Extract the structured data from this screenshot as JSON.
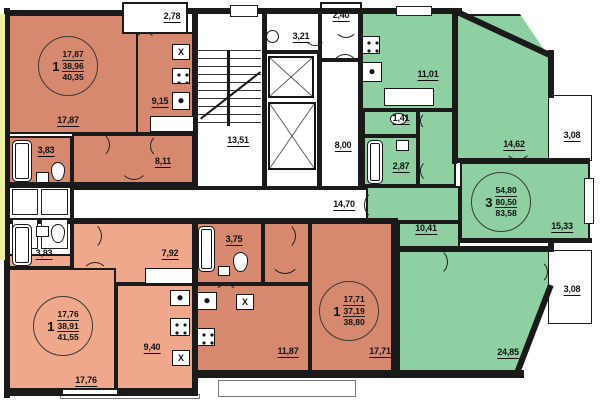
{
  "apartments": [
    {
      "rooms_count": "1",
      "living_area": "17,87",
      "total_area": "38,96",
      "overall_area": "40,35"
    },
    {
      "rooms_count": "1",
      "living_area": "17,76",
      "total_area": "38,91",
      "overall_area": "41,55"
    },
    {
      "rooms_count": "1",
      "living_area": "17,71",
      "total_area": "37,19",
      "overall_area": "38,80"
    },
    {
      "rooms_count": "3",
      "living_area": "54,80",
      "total_area": "80,50",
      "overall_area": "83,58"
    }
  ],
  "labels": {
    "balcony_top_left": "2,78",
    "living_top_left": "17,87",
    "kitchen_top_left": "9,15",
    "bath_top_left": "3,83",
    "hall_top_left": "8,11",
    "stairwell": "13,51",
    "refuse_room": "3,21",
    "vestibule": "2,40",
    "corridor_upper": "8,00",
    "corridor_main": "14,70",
    "kitchen_green": "11,01",
    "wc_green": "1,41",
    "bath_green": "2,87",
    "bedroom_green_top": "14,62",
    "balcony_right_top": "3,08",
    "bedroom_green_right": "15,33",
    "hall_green": "10,41",
    "living_green": "24,85",
    "balcony_right_bottom": "3,08",
    "bath_bottom_left": "3,83",
    "hall_bottom_left": "7,92",
    "living_bottom_left": "17,76",
    "kitchen_bottom_left": "9,40",
    "bath_bottom_center": "3,75",
    "kitchen_bottom_center": "11,87",
    "living_bottom_center": "17,71",
    "stove_mark": "X"
  },
  "colors": {
    "apartment_dark_salmon": "#d6896f",
    "apartment_light_salmon": "#f0a88d",
    "apartment_green": "#8fd0a3",
    "common_area": "#ffffff",
    "walls": "#1a1a1a",
    "loggia_strip": "#eef0a0"
  }
}
